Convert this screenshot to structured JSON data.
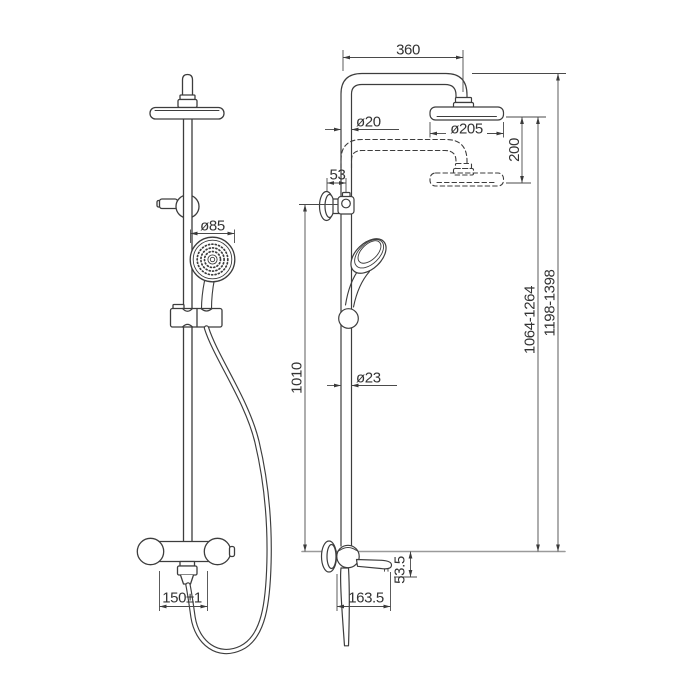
{
  "drawing": {
    "type": "technical-dimension-drawing",
    "subject": "shower-column-with-hand-shower-and-bath-mixer",
    "colors": {
      "background": "#ffffff",
      "outline": "#3d3d3d",
      "dimension_line": "#4a4a4a",
      "baseline": "#9a9a9a",
      "text": "#333333"
    },
    "dimensions": {
      "top_width": "360",
      "pipe_top_diameter": "ø20",
      "head_diameter": "ø205",
      "height_adjustment": "200",
      "wall_offset": "53",
      "handshower_diameter": "ø85",
      "bracket_to_base": "1010",
      "rail_diameter": "ø23",
      "head_height_range": "1064-1264",
      "total_height_range": "1198-1398",
      "inlet_spacing": "150±1",
      "spout_reach": "163.5",
      "spout_height": "53.5"
    }
  }
}
